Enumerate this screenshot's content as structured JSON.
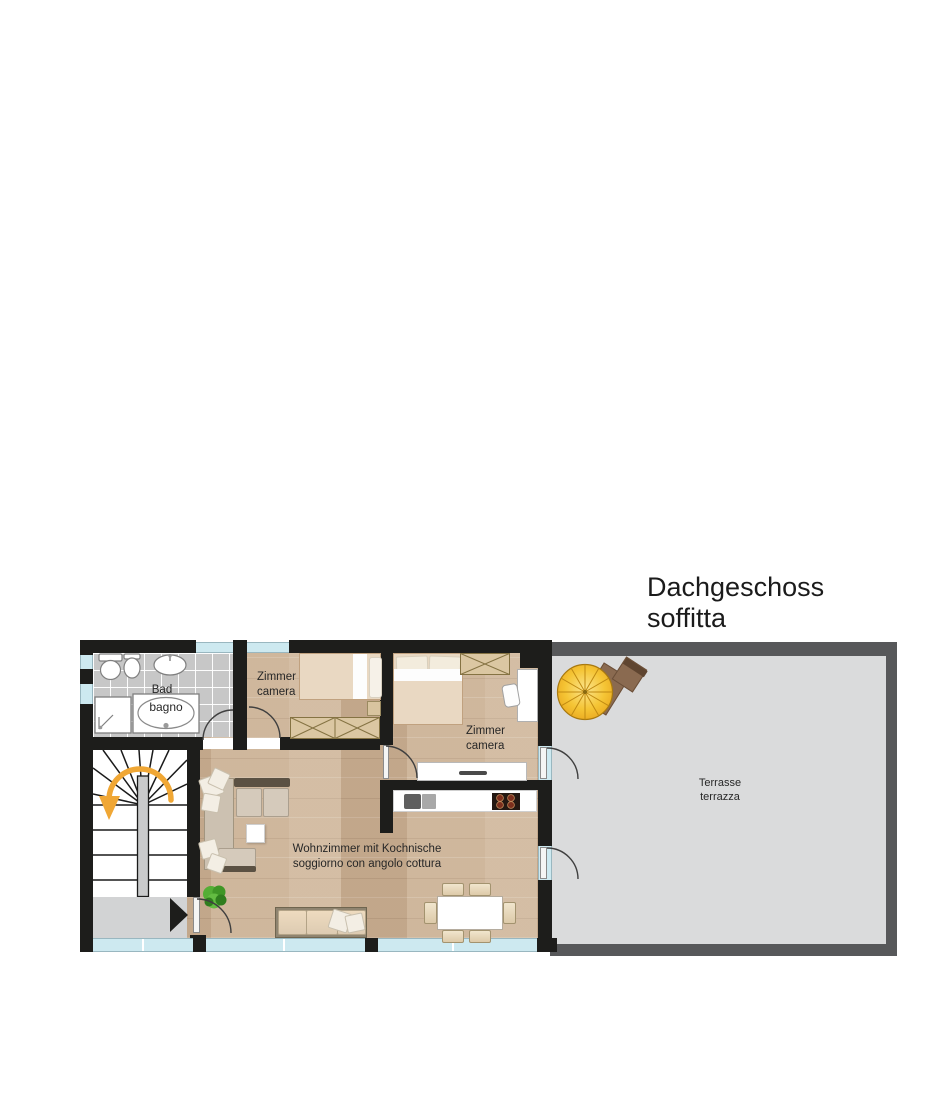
{
  "title": {
    "line1": "Dachgeschoss",
    "line2": "soffitta"
  },
  "rooms": {
    "bathroom": {
      "name_de": "Bad",
      "name_it": "bagno"
    },
    "bedroom_small": {
      "name_de": "Zimmer",
      "name_it": "camera"
    },
    "bedroom_large": {
      "name_de": "Zimmer",
      "name_it": "camera"
    },
    "living_kitchen": {
      "name_de": "Wohnzimmer mit Kochnische",
      "name_it": "soggiorno con angolo cottura"
    },
    "terrace": {
      "name_de": "Terrasse",
      "name_it": "terrazza"
    }
  },
  "colors": {
    "wall": "#1d1d1b",
    "terrace_wall": "#57585a",
    "window_glass": "#cde9f0",
    "wood_floor": "#cab094",
    "tile_floor": "#c7c7c7",
    "terrace_floor": "#dadbdc",
    "stair_arrow": "#f0a735",
    "parasol": "#f5c535"
  }
}
